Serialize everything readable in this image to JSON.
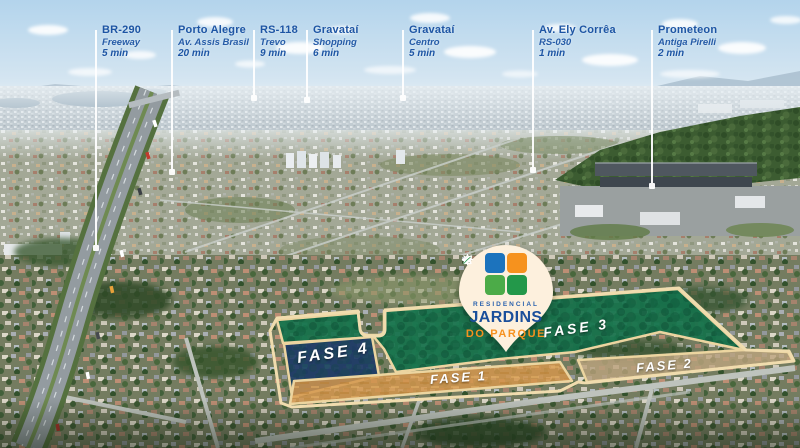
{
  "colors": {
    "label_blue": "#1d55a4",
    "leader_line": "#ffffff",
    "border_tan": "#efdaab",
    "fase1_fill": "#d4974e",
    "fase2_fill": "#c3a878",
    "fase3_fill": "#15714b",
    "fase4_fill": "#1d3a66",
    "pin_cream": "#fdf0dd",
    "brand_blue": "#1b4f9b",
    "brand_orange": "#f6911e"
  },
  "locations": [
    {
      "title": "BR-290",
      "subtitle": "Freeway",
      "time": "5 min"
    },
    {
      "title": "Porto Alegre",
      "subtitle": "Av. Assis Brasil",
      "time": "20 min"
    },
    {
      "title": "RS-118",
      "subtitle": "Trevo",
      "time": "9 min"
    },
    {
      "title": "Gravataí",
      "subtitle": "Shopping",
      "time": "6 min"
    },
    {
      "title": "Gravataí",
      "subtitle": "Centro",
      "time": "5 min"
    },
    {
      "title": "Av. Ely Corrêa",
      "subtitle": "RS-030",
      "time": "1 min"
    },
    {
      "title": "Prometeon",
      "subtitle": "Antiga Pirelli",
      "time": "2 min"
    }
  ],
  "pin": {
    "tagline": "RESIDENCIAL",
    "name": "JARDINS",
    "name2": "DO PARQUE",
    "icons": [
      "bird-icon",
      "sun-icon",
      "house-icon",
      "leaf-icon"
    ]
  },
  "phases": {
    "fase1": "FASE 1",
    "fase2": "FASE 2",
    "fase3": "FASE 3",
    "fase4": "FASE 4"
  }
}
